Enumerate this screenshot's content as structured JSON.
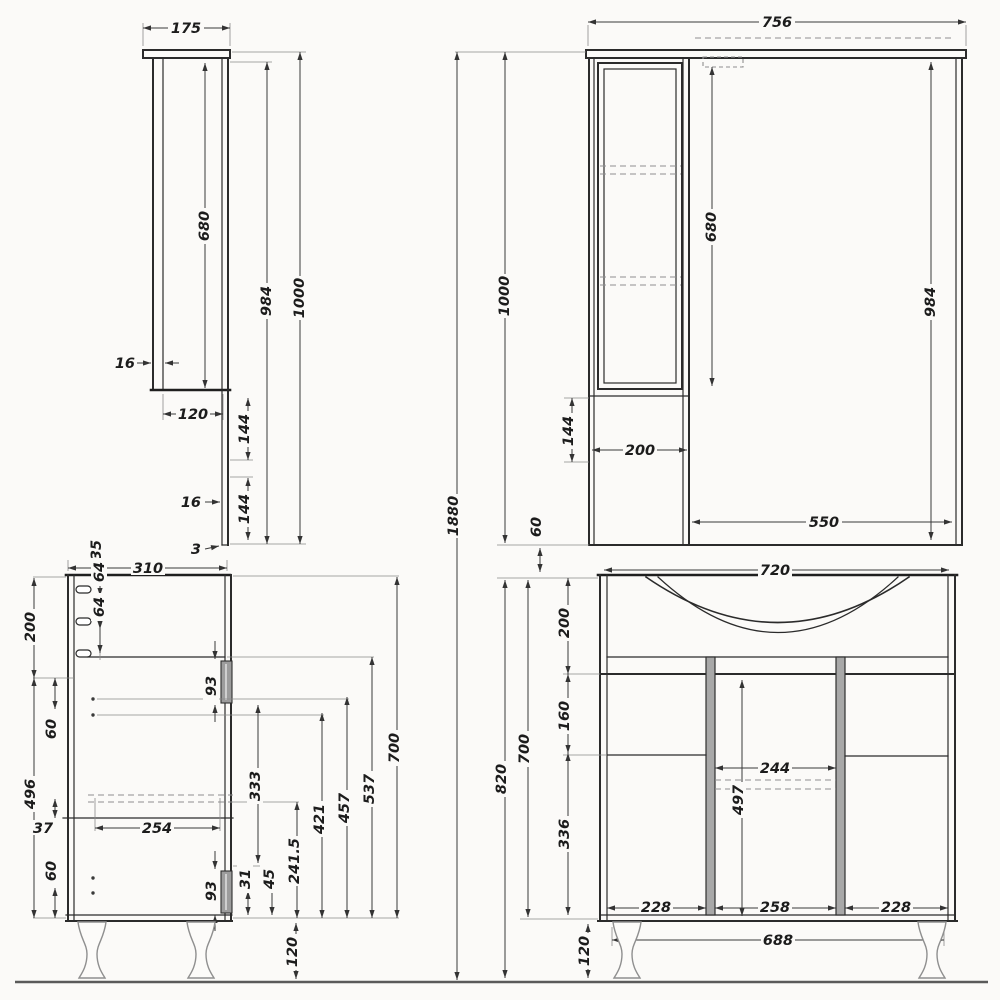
{
  "overall": {
    "total_height": "1880",
    "mirror_gap": "60"
  },
  "mirror_side": {
    "depth": "175",
    "door_height": "680",
    "height_984": "984",
    "height_1000": "1000",
    "door_thk": "16",
    "inner_depth": "120",
    "gap_upper": "144",
    "panel_thk": "16",
    "gap_lower": "144",
    "back_thk": "3"
  },
  "mirror_front": {
    "width": "756",
    "door_height": "680",
    "height_984": "984",
    "height_1000": "1000",
    "gap_144": "144",
    "cabinet_width": "200",
    "mirror_width": "550"
  },
  "vanity_side": {
    "depth": "310",
    "hinge_offset": "35",
    "hinge_gap1": "64",
    "hinge_gap2": "64",
    "top_200": "200",
    "off_60a": "60",
    "side_496": "496",
    "gap_37": "37",
    "off_60b": "60",
    "handle_93a": "93",
    "handle_93b": "93",
    "drawer_254": "254",
    "dim_333": "333",
    "dim_2415": "241.5",
    "dim_421": "421",
    "dim_457": "457",
    "dim_537": "537",
    "height_700": "700",
    "dim_31": "31",
    "dim_45": "45",
    "leg_120": "120"
  },
  "vanity_front": {
    "width": "720",
    "basin_200": "200",
    "mid_160": "160",
    "low_336": "336",
    "mid_width_244": "244",
    "mid_height_497": "497",
    "door_left_228": "228",
    "door_mid_258": "258",
    "door_right_228": "228",
    "base_688": "688",
    "leg_120": "120",
    "height_820": "820",
    "height_700": "700"
  }
}
